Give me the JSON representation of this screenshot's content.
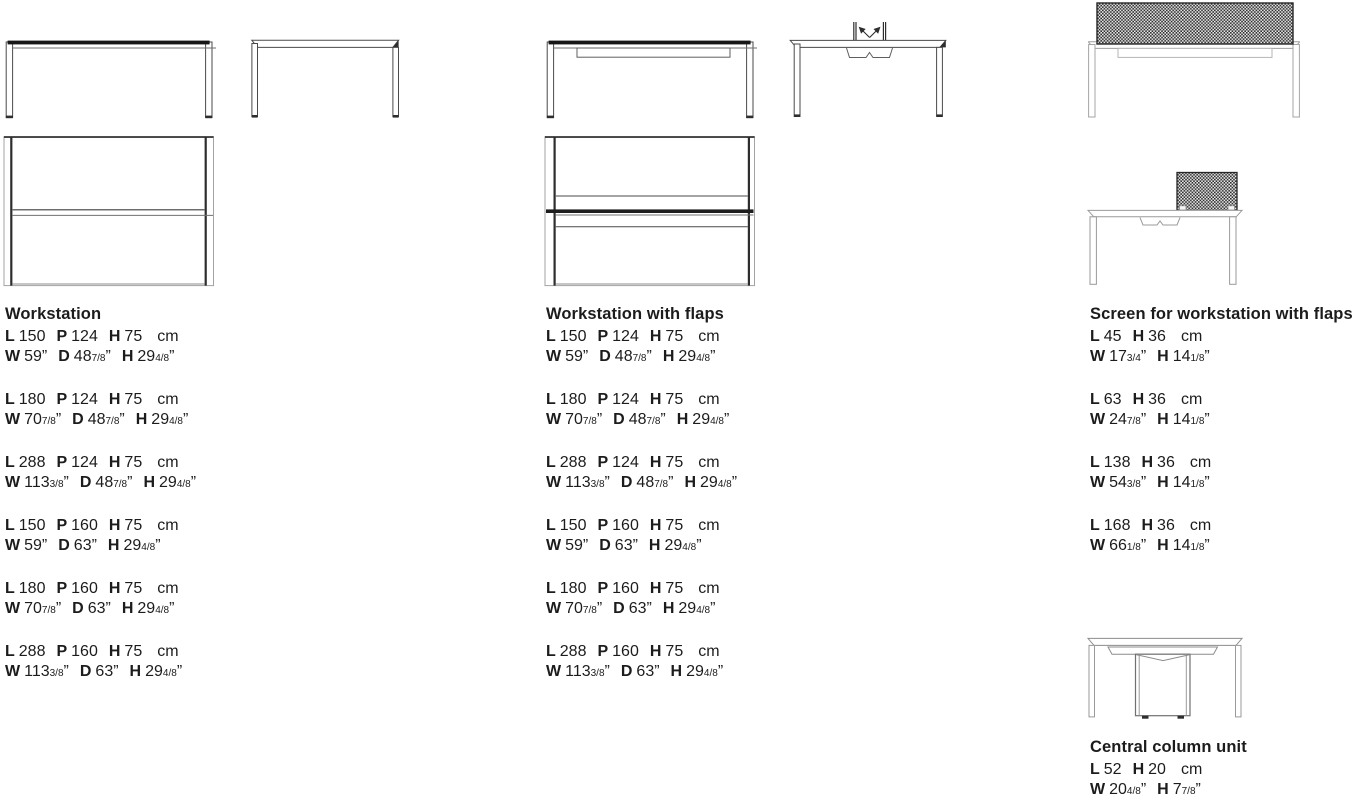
{
  "page": {
    "background": "#ffffff"
  },
  "units": {
    "metric": "cm",
    "imperial": "”"
  },
  "colors": {
    "ink": "#1c1c1c",
    "line_dark": "#3f3f3f",
    "line_light": "#a3a3a3",
    "line_medium": "#8c8c8c",
    "screen_pattern_dark": "#2b2b2b",
    "screen_pattern_light": "#ececec"
  },
  "sections": [
    {
      "title": "Workstation",
      "specs": [
        {
          "cm": [
            [
              "L",
              "150"
            ],
            [
              "P",
              "124"
            ],
            [
              "H",
              "75"
            ]
          ],
          "in": [
            [
              "W",
              "59",
              ""
            ],
            [
              "D",
              "48",
              "7/8"
            ],
            [
              "H",
              "29",
              "4/8"
            ]
          ]
        },
        {
          "cm": [
            [
              "L",
              "180"
            ],
            [
              "P",
              "124"
            ],
            [
              "H",
              "75"
            ]
          ],
          "in": [
            [
              "W",
              "70",
              "7/8"
            ],
            [
              "D",
              "48",
              "7/8"
            ],
            [
              "H",
              "29",
              "4/8"
            ]
          ]
        },
        {
          "cm": [
            [
              "L",
              "288"
            ],
            [
              "P",
              "124"
            ],
            [
              "H",
              "75"
            ]
          ],
          "in": [
            [
              "W",
              "113",
              "3/8"
            ],
            [
              "D",
              "48",
              "7/8"
            ],
            [
              "H",
              "29",
              "4/8"
            ]
          ]
        },
        {
          "cm": [
            [
              "L",
              "150"
            ],
            [
              "P",
              "160"
            ],
            [
              "H",
              "75"
            ]
          ],
          "in": [
            [
              "W",
              "59",
              ""
            ],
            [
              "D",
              "63",
              ""
            ],
            [
              "H",
              "29",
              "4/8"
            ]
          ]
        },
        {
          "cm": [
            [
              "L",
              "180"
            ],
            [
              "P",
              "160"
            ],
            [
              "H",
              "75"
            ]
          ],
          "in": [
            [
              "W",
              "70",
              "7/8"
            ],
            [
              "D",
              "63",
              ""
            ],
            [
              "H",
              "29",
              "4/8"
            ]
          ]
        },
        {
          "cm": [
            [
              "L",
              "288"
            ],
            [
              "P",
              "160"
            ],
            [
              "H",
              "75"
            ]
          ],
          "in": [
            [
              "W",
              "113",
              "3/8"
            ],
            [
              "D",
              "63",
              ""
            ],
            [
              "H",
              "29",
              "4/8"
            ]
          ]
        }
      ]
    },
    {
      "title": "Workstation with flaps",
      "specs": [
        {
          "cm": [
            [
              "L",
              "150"
            ],
            [
              "P",
              "124"
            ],
            [
              "H",
              "75"
            ]
          ],
          "in": [
            [
              "W",
              "59",
              ""
            ],
            [
              "D",
              "48",
              "7/8"
            ],
            [
              "H",
              "29",
              "4/8"
            ]
          ]
        },
        {
          "cm": [
            [
              "L",
              "180"
            ],
            [
              "P",
              "124"
            ],
            [
              "H",
              "75"
            ]
          ],
          "in": [
            [
              "W",
              "70",
              "7/8"
            ],
            [
              "D",
              "48",
              "7/8"
            ],
            [
              "H",
              "29",
              "4/8"
            ]
          ]
        },
        {
          "cm": [
            [
              "L",
              "288"
            ],
            [
              "P",
              "124"
            ],
            [
              "H",
              "75"
            ]
          ],
          "in": [
            [
              "W",
              "113",
              "3/8"
            ],
            [
              "D",
              "48",
              "7/8"
            ],
            [
              "H",
              "29",
              "4/8"
            ]
          ]
        },
        {
          "cm": [
            [
              "L",
              "150"
            ],
            [
              "P",
              "160"
            ],
            [
              "H",
              "75"
            ]
          ],
          "in": [
            [
              "W",
              "59",
              ""
            ],
            [
              "D",
              "63",
              ""
            ],
            [
              "H",
              "29",
              "4/8"
            ]
          ]
        },
        {
          "cm": [
            [
              "L",
              "180"
            ],
            [
              "P",
              "160"
            ],
            [
              "H",
              "75"
            ]
          ],
          "in": [
            [
              "W",
              "70",
              "7/8"
            ],
            [
              "D",
              "63",
              ""
            ],
            [
              "H",
              "29",
              "4/8"
            ]
          ]
        },
        {
          "cm": [
            [
              "L",
              "288"
            ],
            [
              "P",
              "160"
            ],
            [
              "H",
              "75"
            ]
          ],
          "in": [
            [
              "W",
              "113",
              "3/8"
            ],
            [
              "D",
              "63",
              ""
            ],
            [
              "H",
              "29",
              "4/8"
            ]
          ]
        }
      ]
    },
    {
      "title": "Screen for workstation with flaps",
      "specs": [
        {
          "cm": [
            [
              "L",
              "45"
            ],
            [
              "H",
              "36"
            ]
          ],
          "in": [
            [
              "W",
              "17",
              "3/4"
            ],
            [
              "H",
              "14",
              "1/8"
            ]
          ]
        },
        {
          "cm": [
            [
              "L",
              "63"
            ],
            [
              "H",
              "36"
            ]
          ],
          "in": [
            [
              "W",
              "24",
              "7/8"
            ],
            [
              "H",
              "14",
              "1/8"
            ]
          ]
        },
        {
          "cm": [
            [
              "L",
              "138"
            ],
            [
              "H",
              "36"
            ]
          ],
          "in": [
            [
              "W",
              "54",
              "3/8"
            ],
            [
              "H",
              "14",
              "1/8"
            ]
          ]
        },
        {
          "cm": [
            [
              "L",
              "168"
            ],
            [
              "H",
              "36"
            ]
          ],
          "in": [
            [
              "W",
              "66",
              "1/8"
            ],
            [
              "H",
              "14",
              "1/8"
            ]
          ]
        }
      ]
    },
    {
      "title": "Central column unit",
      "specs": [
        {
          "cm": [
            [
              "L",
              "52"
            ],
            [
              "H",
              "20"
            ]
          ],
          "in": [
            [
              "W",
              "20",
              "4/8"
            ],
            [
              "H",
              "7",
              "7/8"
            ]
          ]
        }
      ]
    }
  ]
}
